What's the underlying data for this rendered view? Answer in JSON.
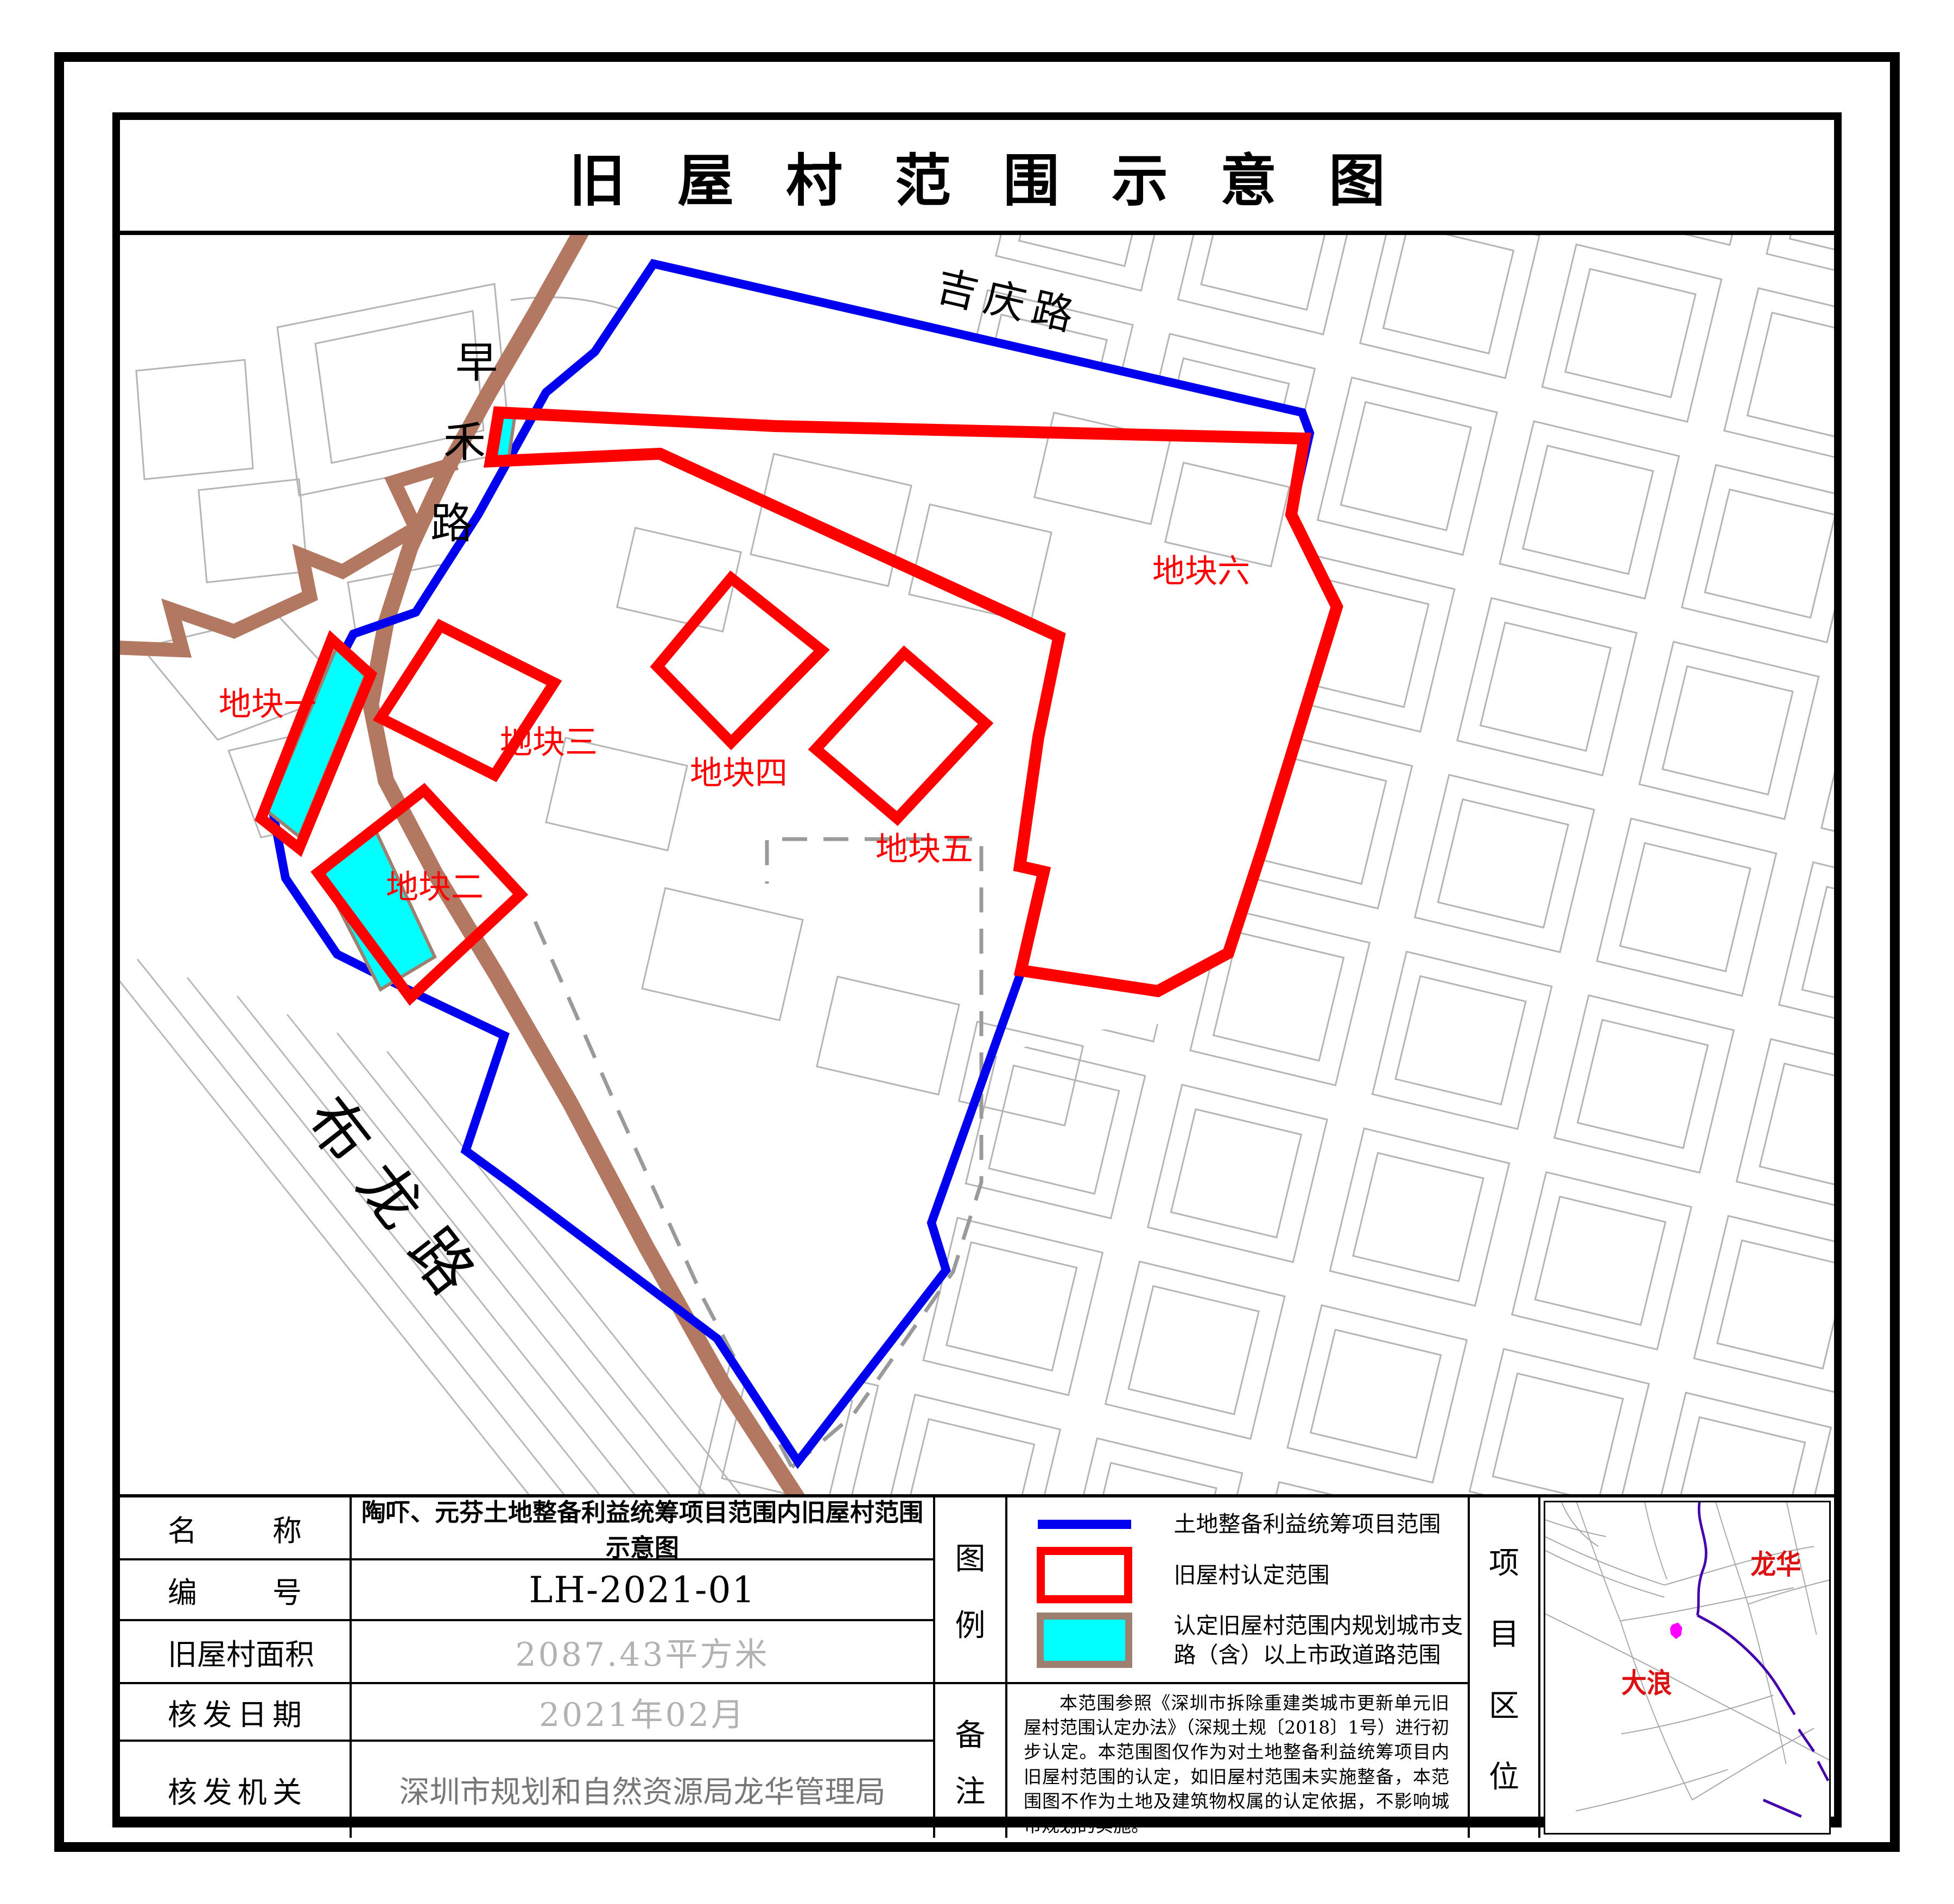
{
  "title": "旧屋村范围示意图",
  "map": {
    "roads": [
      {
        "name": "jiqing-road",
        "label": "吉庆路"
      },
      {
        "name": "zaohe-road",
        "label": "早禾路",
        "chars": [
          "早",
          "禾",
          "路"
        ]
      },
      {
        "name": "bulong-road",
        "label": "布龙路"
      }
    ],
    "plots": [
      {
        "label": "地块一"
      },
      {
        "label": "地块二"
      },
      {
        "label": "地块三"
      },
      {
        "label": "地块四"
      },
      {
        "label": "地块五"
      },
      {
        "label": "地块六"
      }
    ]
  },
  "table": {
    "rows": [
      {
        "label": "名称",
        "value": "陶吓、元芬土地整备利益统筹项目范围内旧屋村范围示意图"
      },
      {
        "label": "编号",
        "value": "LH-2021-01"
      },
      {
        "label": "旧屋村面积",
        "value": "2087.43平方米"
      },
      {
        "label": "核发日期",
        "value": "2021年02月"
      },
      {
        "label": "核发机关",
        "value": "深圳市规划和自然资源局龙华管理局"
      }
    ]
  },
  "legend": {
    "section_label": "图例",
    "items": [
      {
        "swatch": "blue-line",
        "label": "土地整备利益统筹项目范围"
      },
      {
        "swatch": "red-outline",
        "label": "旧屋村认定范围"
      },
      {
        "swatch": "cyan-fill",
        "label": "认定旧屋村范围内规划城市支路（含）以上市政道路范围"
      }
    ]
  },
  "remarks": {
    "section_label": "备注",
    "text": "本范围参照《深圳市拆除重建类城市更新单元旧屋村范围认定办法》（深规土规〔2018〕1号）进行初步认定。本范围图仅作为对土地整备利益统筹项目内旧屋村范围的认定，如旧屋村范围未实施整备，本范围图不作为土地及建筑物权属的认定依据，不影响城市规划的实施。"
  },
  "location": {
    "section_label": "项目区位",
    "labels": [
      {
        "text": "龙华"
      },
      {
        "text": "大浪"
      }
    ]
  },
  "colors": {
    "project_boundary": "#0000ee",
    "village_outline": "#ff0000",
    "municipal_road_fill": "#00ffff",
    "municipal_road_border": "#9e8070",
    "road_brown": "#b27862",
    "parcel_gray": "#b5b5b5",
    "dashed_gray": "#9a9a9a",
    "marker_magenta": "#ff00ff",
    "region_purple": "#4400aa",
    "minimap_label_red": "#dd1111"
  }
}
